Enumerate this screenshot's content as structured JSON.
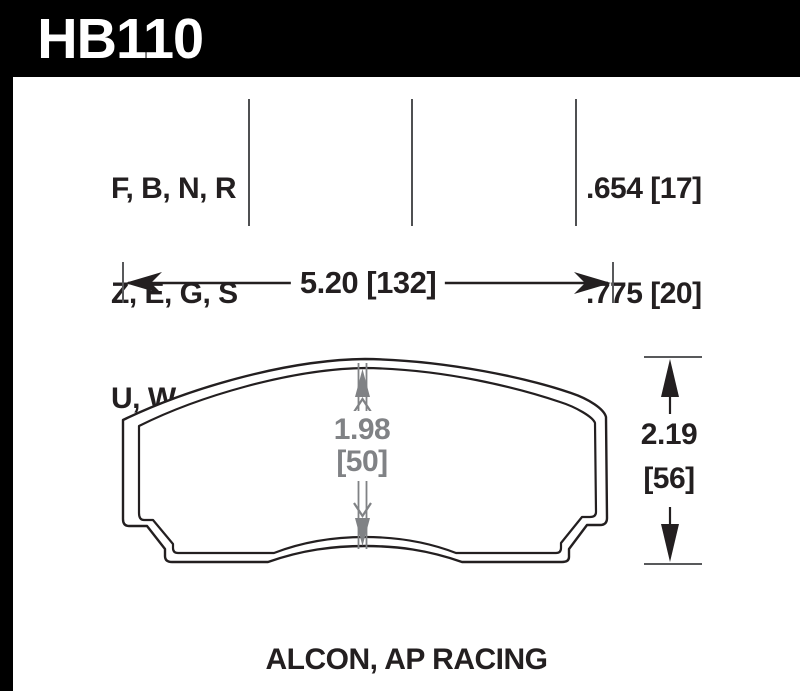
{
  "header": {
    "part_number": "HB110"
  },
  "spec_table": {
    "compounds": [
      "F, B, N, R",
      "Z, E, G, S",
      "U, W"
    ],
    "pad_thickness": [
      ".654 [17]",
      ".775 [20]"
    ]
  },
  "dimensions": {
    "width_label": "5.20 [132]",
    "height_in": "2.19",
    "height_mm": "[56]",
    "center_in": "1.98",
    "center_mm": "[50]"
  },
  "footer": {
    "applications": "ALCON, AP RACING"
  },
  "colors": {
    "header_bg": "#000000",
    "ink": "#231f20",
    "dim_gray": "#808285",
    "tick_gray": "#58595b"
  }
}
